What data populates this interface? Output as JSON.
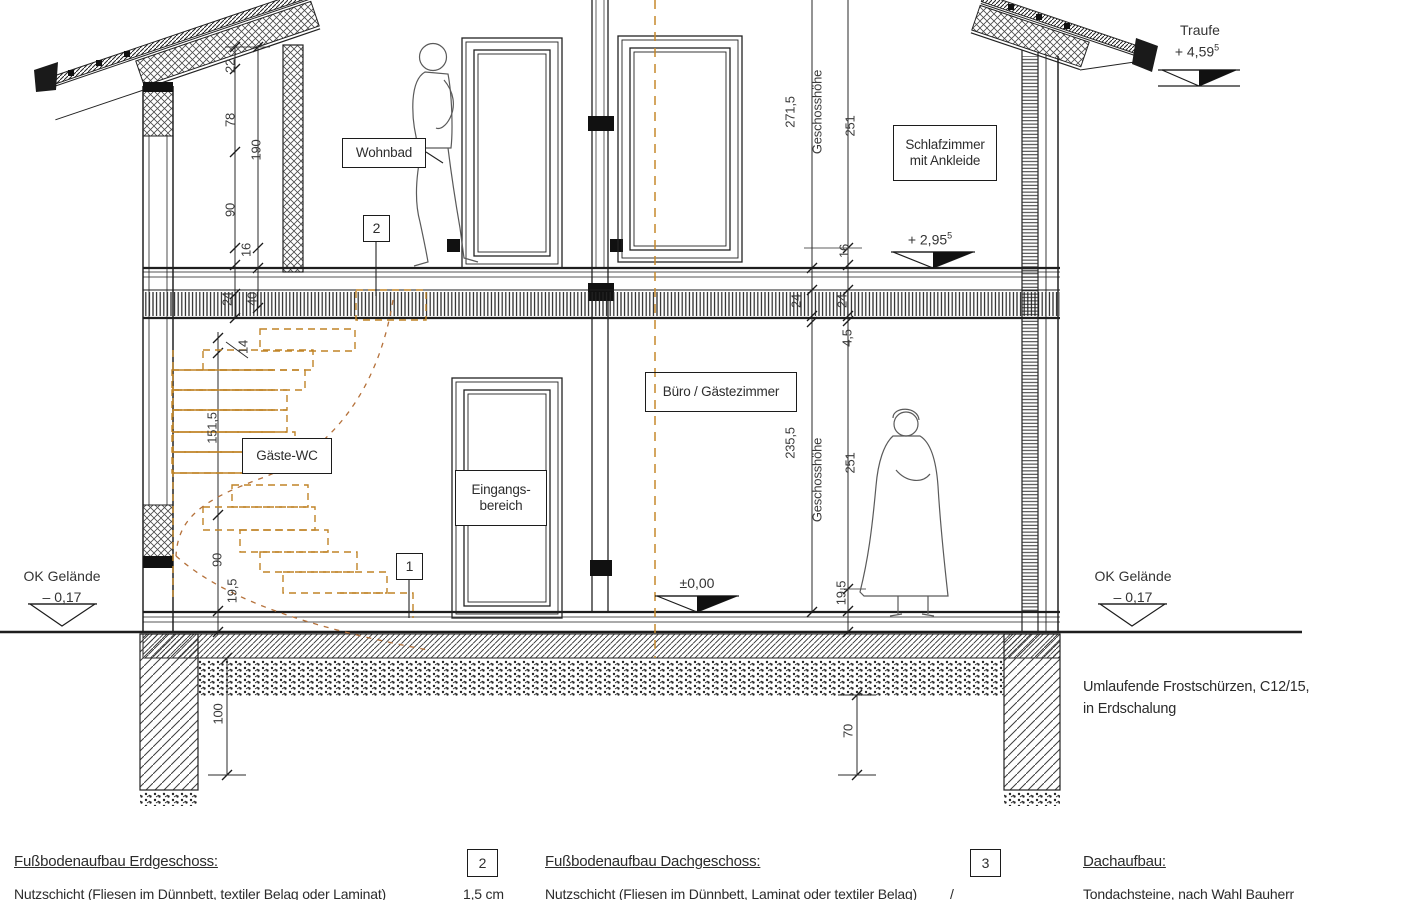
{
  "drawing": {
    "rooms": {
      "wohnbad": "Wohnbad",
      "schlafzimmer_line1": "Schlafzimmer",
      "schlafzimmer_line2": "mit Ankleide",
      "buero": "Büro / Gästezimmer",
      "gaeste_wc": "Gäste-WC",
      "eingang_line1": "Eingangs-",
      "eingang_line2": "bereich"
    },
    "levels": {
      "traufe_label": "Traufe",
      "traufe_value": "+ 4,59",
      "traufe_sup": "5",
      "og_value": "+ 2,95",
      "og_sup": "5",
      "eg_value": "±0,00",
      "gelaende_label": "OK Gelände",
      "gelaende_value": "– 0,17"
    },
    "dims": {
      "v22": "22",
      "v78": "78",
      "v190": "190",
      "v90_og": "90",
      "v16_left": "16",
      "v24_left": "24",
      "v40": "40",
      "v14": "14",
      "v151_5": "151,5",
      "v90_eg": "90",
      "v19_5_left": "19,5",
      "v100": "100",
      "og_height": "271,5",
      "geschosshoehe": "Geschosshöhe",
      "og_room": "251",
      "v16_right": "16",
      "v24_mid": "24",
      "v24_right": "24",
      "v4_5": "4,5",
      "eg_height": "235,5",
      "eg_room": "251",
      "v19_5_right": "19,5",
      "v70": "70"
    },
    "callouts": {
      "one": "1",
      "two": "2",
      "three": "3"
    },
    "notes": {
      "frost_line1": "Umlaufende Frostschürzen, C12/15,",
      "frost_line2": "in Erdschalung"
    },
    "colors": {
      "stair_accent": "#c08427",
      "walkline": "#b5713a",
      "axis_line": "#c5882b",
      "line_work": "#2b2b2b"
    }
  },
  "legend": {
    "eg_title": "Fußbodenaufbau Erdgeschoss:",
    "eg_item": "Nutzschicht (Fliesen im Dünnbett, textiler Belag oder Laminat)",
    "eg_value": "1,5 cm",
    "box2": "2",
    "dg_title": "Fußbodenaufbau Dachgeschoss:",
    "dg_item": "Nutzschicht (Fliesen im Dünnbett, Laminat oder textiler Belag)",
    "dg_value": "/",
    "box3": "3",
    "dach_title": "Dachaufbau:",
    "dach_item": "Tondachsteine, nach Wahl Bauherr"
  }
}
